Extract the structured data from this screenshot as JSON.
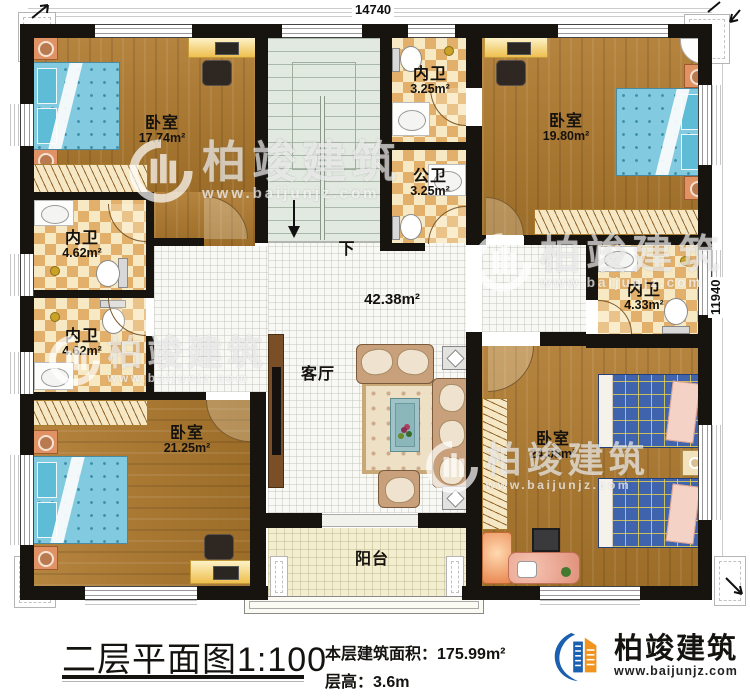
{
  "plan": {
    "dimensions": {
      "top": "14740",
      "right": "11940"
    },
    "stairs_label": "下",
    "rooms": [
      {
        "id": "bedroom-top-left",
        "name": "卧室",
        "area": "17.74m²"
      },
      {
        "id": "bathroom-ensuite-top",
        "name": "内卫",
        "area": "3.25m²"
      },
      {
        "id": "bathroom-public",
        "name": "公卫",
        "area": "3.25m²"
      },
      {
        "id": "bedroom-top-right",
        "name": "卧室",
        "area": "19.80m²"
      },
      {
        "id": "bathroom-left-upper",
        "name": "内卫",
        "area": "4.62m²"
      },
      {
        "id": "bathroom-left-lower",
        "name": "内卫",
        "area": "4.62m²"
      },
      {
        "id": "bathroom-right",
        "name": "内卫",
        "area": "4.33m²"
      },
      {
        "id": "living-room",
        "name": "客厅",
        "area": "42.38m²"
      },
      {
        "id": "bedroom-bottom-left",
        "name": "卧室",
        "area": "21.25m²"
      },
      {
        "id": "bedroom-bottom-right",
        "name": "卧室",
        "area": "24.08m²"
      },
      {
        "id": "balcony",
        "name": "阳台",
        "area": ""
      }
    ]
  },
  "watermark": {
    "brand": "柏竣建筑",
    "url": "www.baijunjz.com"
  },
  "caption": {
    "title": "二层平面图1:100",
    "area_label": "本层建筑面积：",
    "area_value": "175.99m²",
    "height_label": "层高：",
    "height_value": "3.6m"
  },
  "logo": {
    "brand": "柏竣建筑",
    "url": "www.baijunjz.com"
  },
  "colors": {
    "wall": "#17130e",
    "wood_floor": "#aa7930",
    "tile_light": "#f7e9c3",
    "tile_dark": "#e2b06a",
    "living_tile": "#f8f8f5",
    "balcony_tile": "#f3eecf",
    "stair_floor": "#e2e9e0",
    "bed_blue": "#82cadf",
    "bed_plaid": "#3f63ad",
    "brand_blue": "#1a5fb0",
    "brand_orange": "#f0941f"
  }
}
